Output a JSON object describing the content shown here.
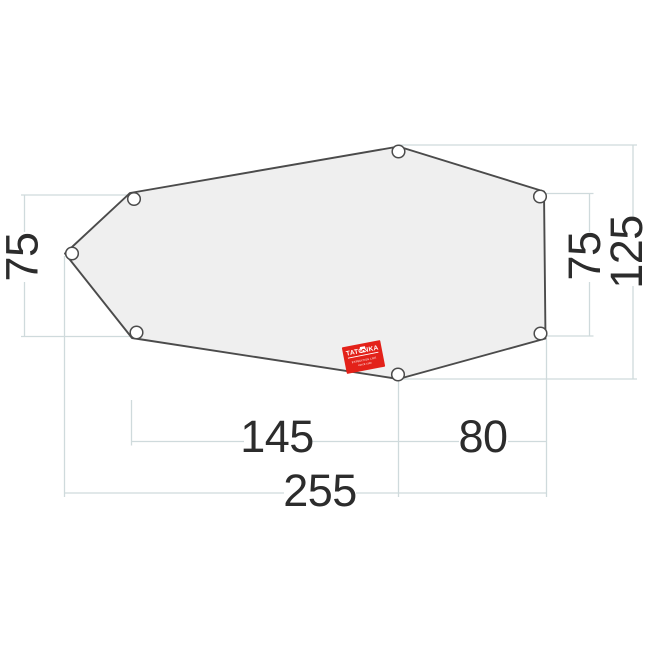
{
  "diagram": {
    "type": "tent-footprint-dimension-drawing",
    "dimensions": {
      "left_height": "75",
      "right_height": "75",
      "total_height": "125",
      "bottom_left_width": "145",
      "bottom_right_width": "80",
      "total_width": "255"
    },
    "label": {
      "brand": "TATONKA",
      "fineprint_line1": "EXPEDITION LIFE",
      "fineprint_line2": "SINCE 1980"
    },
    "colors": {
      "shape_fill": "#efefef",
      "shape_stroke": "#4b4b4b",
      "dimension_line": "#cfdadc",
      "text": "#2c2c2c",
      "label_red": "#e32119"
    }
  }
}
